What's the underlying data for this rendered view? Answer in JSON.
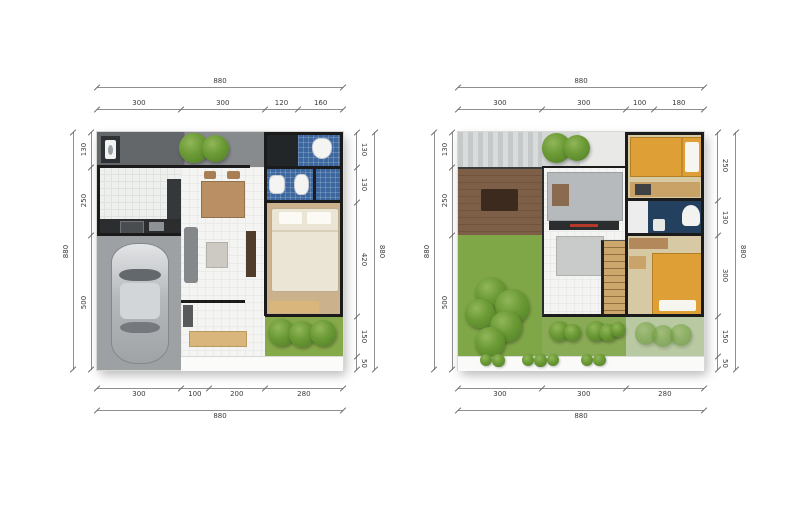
{
  "palette": {
    "wall": "#1b1b1b",
    "bathroom_tile_blue": "#3c689f",
    "bathroom_dark_navy": "#24405f",
    "bedroom_floor_tan": "#cbb28c",
    "bed_yellow": "#dd9f36",
    "grass_green": "#7fa647",
    "grass_light": "#b9caa3",
    "bush_green": "#6b9a35",
    "deck_wood_brown": "#7d5e47",
    "garage_gray": "#9da1a4",
    "porch_dark_gray": "#63676a",
    "dimension_text": "#3a3a3a"
  },
  "plans": [
    {
      "id": "ground-floor",
      "dims": {
        "top_total": "880",
        "top_segments": [
          "300",
          "300",
          "120",
          "160"
        ],
        "left_total": "880",
        "left_segments": [
          "130",
          "250",
          "500"
        ],
        "right_segments": [
          "130",
          "130",
          "420",
          "150",
          "50"
        ],
        "bottom_segments": [
          "300",
          "100",
          "200",
          "280"
        ],
        "bottom_total": "880"
      }
    },
    {
      "id": "upper-floor",
      "dims": {
        "top_total": "880",
        "top_segments": [
          "300",
          "300",
          "100",
          "180"
        ],
        "left_total": "880",
        "left_segments": [
          "130",
          "250",
          "500"
        ],
        "right_segments": [
          "250",
          "130",
          "300",
          "150",
          "50"
        ],
        "bottom_segments": [
          "300",
          "300",
          "280"
        ],
        "bottom_total": "880"
      }
    }
  ]
}
